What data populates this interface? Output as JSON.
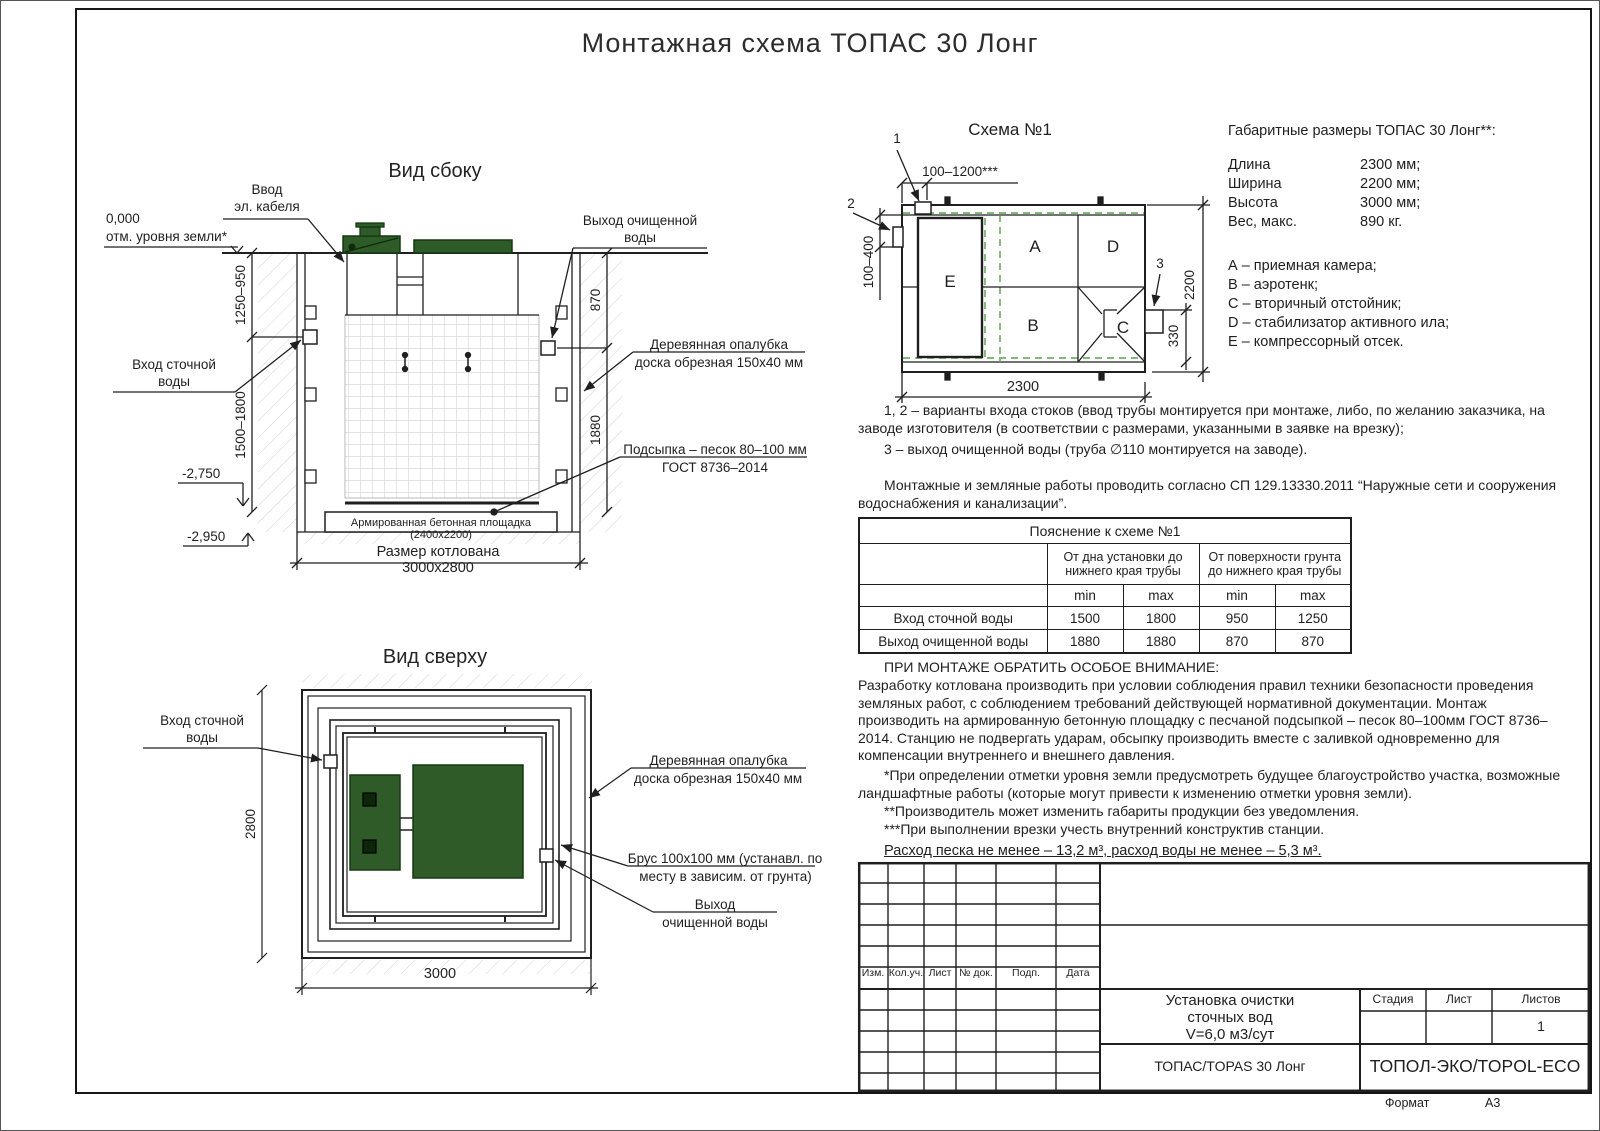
{
  "page": {
    "title": "Монтажная схема ТОПАС 30 Лонг",
    "format_label": "Формат",
    "format_value": "А3"
  },
  "colors": {
    "line": "#1f1f1f",
    "lid_green": "#2e5b28",
    "dash_green": "#58a04c"
  },
  "side_view": {
    "title": "Вид сбоку",
    "zero_mark": "0,000",
    "zero_sub": "отм. уровня земли*",
    "cable_label": "Ввод\nэл. кабеля",
    "outlet_label": "Выход очищенной\nводы",
    "inlet_label": "Вход сточной\nводы",
    "formwork_l1": "Деревянная опалубка",
    "formwork_l2": "доска обрезная 150х40 мм",
    "bedding_l1": "Подсыпка – песок 80–100 мм",
    "bedding_l2": "ГОСТ 8736–2014",
    "slab_label": "Армированная бетонная площадка (2400х2200)",
    "pit_label": "Размер котлована 3000х2800",
    "dim_upper_left": "1250–950",
    "dim_lower_left": "1500–1800",
    "dim_upper_right": "870",
    "dim_lower_right": "1880",
    "level_1": "-2,750",
    "level_2": "-2,950"
  },
  "top_view": {
    "title": "Вид сверху",
    "inlet_label": "Вход сточной\nводы",
    "formwork_l1": "Деревянная опалубка",
    "formwork_l2": "доска обрезная 150х40 мм",
    "beam_l1": "Брус 100х100 мм (устанавл. по",
    "beam_l2": "месту в зависим. от грунта)",
    "outlet_l1": "Выход",
    "outlet_l2": "очищенной воды",
    "dim_width": "2800",
    "dim_length": "3000"
  },
  "scheme": {
    "title": "Схема №1",
    "chambers": {
      "a": "A",
      "b": "B",
      "c": "C",
      "d": "D",
      "e": "E"
    },
    "markers": {
      "m1": "1",
      "m2": "2",
      "m3": "3"
    },
    "dim_inlet_top": "100–1200***",
    "dim_inlet_side": "100–400",
    "dim_height": "2200",
    "dim_outlet": "330",
    "dim_length": "2300"
  },
  "dims_panel": {
    "title": "Габаритные размеры ТОПАС 30 Лонг**:",
    "rows": [
      {
        "label": "Длина",
        "value": "2300 мм;"
      },
      {
        "label": "Ширина",
        "value": "2200 мм;"
      },
      {
        "label": "Высота",
        "value": "3000 мм;"
      },
      {
        "label": "Вес, макс.",
        "value": "890 кг."
      }
    ],
    "legend": [
      "А – приемная камера;",
      "В – аэротенк;",
      "С – вторичный отстойник;",
      "D – стабилизатор активного ила;",
      "Е – компрессорный отсек."
    ]
  },
  "notes": {
    "variants": "1, 2 – варианты входа  стоков (ввод трубы монтируется при монтаже, либо, по желанию заказчика, на заводе изготовителя (в соответствии с размерами, указанными в заявке на врезку);",
    "outlet": "3 – выход очищенной воды (труба ∅110 монтируется на заводе).",
    "works": "Монтажные и земляные работы проводить согласно СП 129.13330.2011 “Наружные сети и сооружения водоснабжения и канализации”."
  },
  "table": {
    "title": "Пояснение к схеме №1",
    "group_bottom": "От дна установки до\nнижнего края трубы",
    "group_surface": "От поверхности грунта\nдо нижнего края трубы",
    "min_label": "min",
    "max_label": "max",
    "rows": [
      {
        "label": "Вход сточной воды",
        "values": [
          "1500",
          "1800",
          "950",
          "1250"
        ]
      },
      {
        "label": "Выход очищенной воды",
        "values": [
          "1880",
          "1880",
          "870",
          "870"
        ]
      }
    ]
  },
  "attention": {
    "heading": "ПРИ МОНТАЖЕ ОБРАТИТЬ ОСОБОЕ ВНИМАНИЕ:",
    "body": "Разработку котлована производить при условии соблюдения правил техники безопасности проведения земляных работ, с соблюдением требований действующей нормативной документации.  Монтаж производить на армированную бетонную площадку с песчаной подсыпкой – песок 80–100мм ГОСТ 8736–2014. Станцию не подвергать ударам, обсыпку производить вместе с заливкой одновременно для компенсации внутреннего и внешнего давления.",
    "footnote1": "*При определении отметки уровня земли предусмотреть будущее благоустройство участка, возможные ландшафтные работы (которые могут привести к изменению отметки уровня земли).",
    "footnote2": "**Производитель может изменить габариты продукции без уведомления.",
    "footnote3": "***При выполнении врезки учесть внутренний конструктив станции.",
    "consumption": "Расход песка не менее – 13,2 м³, расход воды не менее – 5,3 м³."
  },
  "stamp": {
    "cols": [
      "Изм.",
      "Кол.уч.",
      "Лист",
      "№ док.",
      "Подп.",
      "Дата"
    ],
    "object_title": "Установка очистки\nсточных вод\nV=6,0 м3/сут",
    "stage_label": "Стадия",
    "sheet_label": "Лист",
    "sheets_label": "Листов",
    "sheets_value": "1",
    "model": "ТОПАС/TOPAS 30 Лонг",
    "company": "ТОПОЛ-ЭКО/TOPOL-ECO"
  }
}
